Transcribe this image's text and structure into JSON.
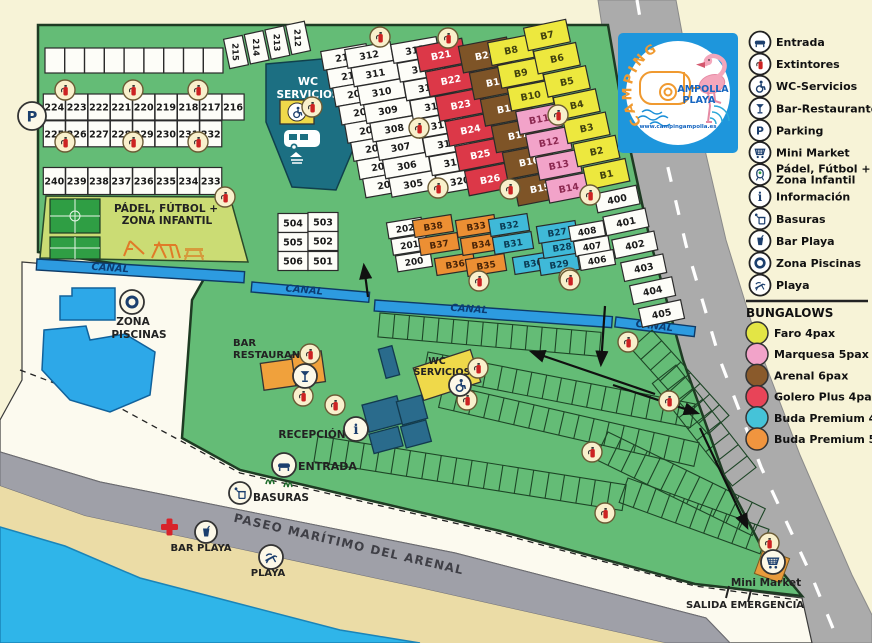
{
  "colors": {
    "background": "#F7F3D7",
    "map_green": "#64BC76",
    "canal_blue": "#2D9BE0",
    "sea": "#2FB5E9",
    "sand": "#EBDCA6",
    "road": "#ABABAB",
    "building_teal": "#1C6F82",
    "building_blue": "#2A6B8C",
    "building_yellow": "#EFD94A",
    "building_orange": "#F0A13C",
    "faro_yellow": "#EDE83E",
    "marquesa_pink": "#F2A3C9",
    "arenal_brown": "#7E5427",
    "golero_red": "#DC3848",
    "buda4_cyan": "#3FB9D8",
    "buda5_orange": "#EC8F33"
  },
  "logo": {
    "arc": "CAMPING",
    "line1": "AMPOLLA",
    "line2": "PLAYA",
    "url": "www.campingampolla.es"
  },
  "legend": {
    "items": [
      {
        "name": "entrada-icon",
        "sym": "ic-entrada",
        "label": "Entrada"
      },
      {
        "name": "extintores-icon",
        "sym": "ic-ext",
        "label": "Extintores"
      },
      {
        "name": "wc-servicios-icon",
        "sym": "ic-wc",
        "label": "WC-Servicios"
      },
      {
        "name": "bar-restaurante-icon",
        "sym": "ic-bar",
        "label": "Bar-Restaurante"
      },
      {
        "name": "parking-icon",
        "sym": "ic-parking",
        "label": "Parking"
      },
      {
        "name": "mini-market-icon",
        "sym": "ic-market",
        "label": "Mini Market"
      },
      {
        "name": "padel-icon",
        "sym": "ic-padel",
        "label": "Pádel, Fútbol +\nZona Infantil"
      },
      {
        "name": "informacion-icon",
        "sym": "ic-info",
        "label": "Información"
      },
      {
        "name": "basuras-icon",
        "sym": "ic-basuras",
        "label": "Basuras"
      },
      {
        "name": "bar-playa-icon",
        "sym": "ic-barplaya",
        "label": "Bar Playa"
      },
      {
        "name": "zona-piscinas-icon",
        "sym": "ic-piscinas",
        "label": "Zona Piscinas"
      },
      {
        "name": "playa-icon",
        "sym": "ic-playa",
        "label": "Playa"
      }
    ],
    "bungalows_title": "BUNGALOWS",
    "bungalows": [
      {
        "color": "#E3E545",
        "label": "Faro 4pax"
      },
      {
        "color": "#F2A3C9",
        "label": "Marquesa 5pax"
      },
      {
        "color": "#8A5A2B",
        "label": "Arenal 6pax"
      },
      {
        "color": "#E84458",
        "label": "Golero Plus 4pax"
      },
      {
        "color": "#45C3D8",
        "label": "Buda Premium 4pax"
      },
      {
        "color": "#F0953F",
        "label": "Buda Premium 5pax"
      }
    ]
  },
  "map_labels": {
    "wc_top_1": "WC",
    "wc_top_2": "SERVICIOS",
    "padel_1": "PÁDEL, FÚTBOL +",
    "padel_2": "ZONA INFANTIL",
    "canal": "CANAL",
    "piscinas_1": "ZONA",
    "piscinas_2": "PISCINAS",
    "bar_1": "BAR",
    "bar_2": "RESTAURANTE",
    "wc_mid_1": "WC",
    "wc_mid_2": "SERVICIOS",
    "recepcion": "RECEPCIÓN",
    "entrada": "ENTRADA",
    "basuras": "BASURAS",
    "paseo": "PASEO MARÍTIMO DEL ARENAL",
    "bar_playa": "BAR PLAYA",
    "playa": "PLAYA",
    "mini_market": "Mini Market",
    "salida": "SALIDA EMERGENCIA"
  },
  "plot_groups": [
    {
      "x0": 54.8,
      "y0": 60.5,
      "dx": 19.8,
      "dy": 0,
      "n": 9,
      "w": 19.6,
      "h": 25,
      "r": 0,
      "f": "#FDFDF8",
      "labels": []
    },
    {
      "x0": 54.3,
      "y0": 107,
      "dx": 22.35,
      "dy": 0,
      "n": 9,
      "w": 22,
      "h": 26,
      "r": 0,
      "f": "#FDFDF8",
      "labels": [
        "224",
        "223",
        "222",
        "221",
        "220",
        "219",
        "218",
        "217",
        "216"
      ]
    },
    {
      "x0": 54.3,
      "y0": 133.8,
      "dx": 22.35,
      "dy": 0,
      "n": 8,
      "w": 22,
      "h": 26,
      "r": 0,
      "f": "#FDFDF8",
      "labels": [
        "225",
        "226",
        "227",
        "228",
        "229",
        "230",
        "231",
        "232"
      ]
    },
    {
      "x0": 54.3,
      "y0": 181,
      "dx": 22.35,
      "dy": 0,
      "n": 8,
      "w": 22,
      "h": 27,
      "r": 0,
      "f": "#FDFDF8",
      "labels": [
        "240",
        "239",
        "238",
        "237",
        "236",
        "235",
        "234",
        "233"
      ]
    },
    {
      "x0": 236,
      "y0": 52,
      "dx": 20.7,
      "dy": -4.7,
      "n": 4,
      "w": 19,
      "h": 30,
      "r": -12,
      "tr": 100,
      "fs": 8.5,
      "f": "#FDFDF8",
      "labels": [
        "215",
        "214",
        "213",
        "212"
      ]
    },
    {
      "x0": 345,
      "y0": 57,
      "dx": 6.0,
      "dy": 18.2,
      "n": 8,
      "w": 46,
      "h": 19,
      "r": -10,
      "f": "#FDFDF8",
      "labels": [
        "211",
        "210",
        "209",
        "208",
        "207",
        "206",
        "205",
        "204"
      ]
    },
    {
      "x0": 369,
      "y0": 55,
      "dx": 6.3,
      "dy": 18.4,
      "n": 8,
      "w": 46,
      "h": 19,
      "r": -10,
      "f": "#FDFDF8",
      "labels": [
        "312",
        "311",
        "310",
        "309",
        "308",
        "307",
        "306",
        "305"
      ]
    },
    {
      "x0": 415,
      "y0": 50,
      "dx": 6.4,
      "dy": 18.7,
      "n": 8,
      "w": 46,
      "h": 19,
      "r": -10,
      "f": "#FDFDF8",
      "labels": [
        "313",
        "314",
        "315",
        "316",
        "317",
        "318",
        "319",
        "320"
      ]
    },
    {
      "x0": 441,
      "y0": 55,
      "dx": 9.8,
      "dy": 24.8,
      "n": 6,
      "w": 47,
      "h": 25,
      "r": -11,
      "f": "#DC3848",
      "tc": "#ffffff",
      "labels": [
        "B21",
        "B22",
        "B23",
        "B24",
        "B25",
        "B26"
      ]
    },
    {
      "x0": 485,
      "y0": 55,
      "dx": 11,
      "dy": 26.6,
      "n": 6,
      "w": 49,
      "h": 27,
      "r": -11,
      "f": "#7E5427",
      "tc": "#ffffff",
      "labels": [
        "B20",
        "B19",
        "B18",
        "B17",
        "B16",
        "B15"
      ]
    },
    {
      "x0": 511,
      "y0": 50,
      "dx": 9.8,
      "dy": 22.8,
      "n": 3,
      "w": 43,
      "h": 23,
      "r": -11,
      "f": "#EDE83E",
      "tc": "#41410f",
      "labels": [
        "B8",
        "B9",
        "B10"
      ]
    },
    {
      "x0": 539,
      "y0": 119,
      "dx": 9.9,
      "dy": 22.9,
      "n": 4,
      "w": 43,
      "h": 23,
      "r": -11,
      "f": "#F2A3C9",
      "tc": "#8c2850",
      "labels": [
        "B11",
        "B12",
        "B13",
        "B14"
      ]
    },
    {
      "x0": 547,
      "y0": 35,
      "dx": 9.9,
      "dy": 23.2,
      "n": 7,
      "w": 43,
      "h": 23,
      "r": -12,
      "f": "#EDE83E",
      "tc": "#41410f",
      "labels": [
        "B7",
        "B6",
        "B5",
        "B4",
        "B3",
        "B2",
        "B1"
      ]
    },
    {
      "x0": 617,
      "y0": 199,
      "dx": 8.9,
      "dy": 22.9,
      "n": 6,
      "w": 43,
      "h": 19,
      "r": -12,
      "f": "#FDFDF8",
      "labels": [
        "400",
        "401",
        "402",
        "403",
        "404",
        "405"
      ]
    },
    {
      "x0": 405,
      "y0": 228,
      "dx": 4.5,
      "dy": 16.6,
      "n": 3,
      "w": 35,
      "h": 16,
      "r": -9,
      "fs": 9,
      "f": "#FDFDF8",
      "labels": [
        "202",
        "201",
        "200"
      ]
    },
    {
      "cells": [
        [
          433,
          226
        ],
        [
          439,
          244
        ],
        [
          455,
          264
        ],
        [
          486,
          265
        ],
        [
          481,
          244
        ],
        [
          476,
          226
        ]
      ],
      "w": 39,
      "h": 17,
      "r": -9,
      "fs": 9,
      "f": "#EC8F33",
      "tc": "#4a2408",
      "labels": [
        "B38",
        "B37",
        "B36",
        "B35",
        "B34",
        "B33"
      ]
    },
    {
      "cells": [
        [
          509,
          225
        ],
        [
          513,
          243
        ],
        [
          533,
          263
        ],
        [
          559,
          264
        ],
        [
          562,
          247
        ],
        [
          557,
          232
        ]
      ],
      "w": 39,
      "h": 17,
      "r": -9,
      "fs": 9,
      "f": "#3FB9D8",
      "tc": "#0c3c54",
      "labels": [
        "B32",
        "B31",
        "B30",
        "B29",
        "B28",
        "B27"
      ]
    },
    {
      "cells": [
        [
          587,
          231
        ],
        [
          592,
          246
        ],
        [
          597,
          260
        ]
      ],
      "w": 35,
      "h": 15,
      "r": -10,
      "fs": 9,
      "f": "#FDFDF8",
      "labels": [
        "408",
        "407",
        "406"
      ]
    },
    {
      "cells": [
        [
          293,
          223
        ],
        [
          323,
          222
        ],
        [
          293,
          242
        ],
        [
          323,
          241
        ],
        [
          293,
          261
        ],
        [
          323,
          261
        ]
      ],
      "w": 30,
      "h": 19,
      "r": 0,
      "f": "#FDFDF8",
      "labels": [
        "504",
        "503",
        "505",
        "502",
        "506",
        "501"
      ]
    }
  ],
  "bands": [
    {
      "x": 380,
      "y": 313,
      "a": 5,
      "l": 222,
      "h": 24,
      "n": 14
    },
    {
      "x": 428,
      "y": 352,
      "a": 11,
      "l": 272,
      "h": 24,
      "n": 17
    },
    {
      "x": 444,
      "y": 384,
      "a": 13,
      "l": 262,
      "h": 24,
      "n": 16
    },
    {
      "x": 318,
      "y": 436,
      "a": 9,
      "l": 312,
      "h": 26,
      "n": 19
    },
    {
      "x": 652,
      "y": 330,
      "a": 48,
      "l": 115,
      "h": 28,
      "n": 7
    },
    {
      "x": 608,
      "y": 432,
      "a": 26,
      "l": 175,
      "h": 30,
      "n": 11
    },
    {
      "x": 628,
      "y": 478,
      "a": 20,
      "l": 150,
      "h": 26,
      "n": 9
    },
    {
      "x": 676,
      "y": 365,
      "a": 52,
      "l": 130,
      "h": 30,
      "n": 8
    }
  ],
  "extinguishers": [
    [
      65,
      90
    ],
    [
      133,
      90
    ],
    [
      198,
      90
    ],
    [
      65,
      142
    ],
    [
      133,
      142
    ],
    [
      198,
      142
    ],
    [
      225,
      197
    ],
    [
      312,
      107
    ],
    [
      380,
      37
    ],
    [
      448,
      38
    ],
    [
      419,
      128
    ],
    [
      558,
      115
    ],
    [
      590,
      195
    ],
    [
      569,
      278
    ],
    [
      438,
      188
    ],
    [
      510,
      189
    ],
    [
      479,
      281
    ],
    [
      570,
      280
    ],
    [
      310,
      354
    ],
    [
      303,
      396
    ],
    [
      335,
      405
    ],
    [
      478,
      368
    ],
    [
      467,
      400
    ],
    [
      628,
      342
    ],
    [
      669,
      401
    ],
    [
      592,
      452
    ],
    [
      605,
      513
    ],
    [
      769,
      543
    ]
  ],
  "facilities": [
    {
      "name": "parking-icon",
      "sym": "ic-parking",
      "x": 32,
      "y": 116,
      "r": 14
    },
    {
      "name": "zona-piscinas-icon",
      "sym": "ic-piscinas",
      "x": 132,
      "y": 302,
      "r": 12
    },
    {
      "name": "bar-restaurante-icon",
      "sym": "ic-bar",
      "x": 305,
      "y": 376,
      "r": 12
    },
    {
      "name": "informacion-icon",
      "sym": "ic-info",
      "x": 356,
      "y": 429,
      "r": 12
    },
    {
      "name": "wc-servicios-icon",
      "sym": "ic-wc",
      "x": 460,
      "y": 385,
      "r": 11
    },
    {
      "name": "entrada-icon",
      "sym": "ic-entrada",
      "x": 284,
      "y": 465,
      "r": 12
    },
    {
      "name": "basuras-icon",
      "sym": "ic-basuras",
      "x": 240,
      "y": 493,
      "r": 11
    },
    {
      "name": "bar-playa-icon",
      "sym": "ic-barplaya",
      "x": 206,
      "y": 532,
      "r": 11
    },
    {
      "name": "playa-icon",
      "sym": "ic-playa",
      "x": 271,
      "y": 557,
      "r": 12
    },
    {
      "name": "mini-market-icon",
      "sym": "ic-market",
      "x": 773,
      "y": 562,
      "r": 12
    }
  ]
}
